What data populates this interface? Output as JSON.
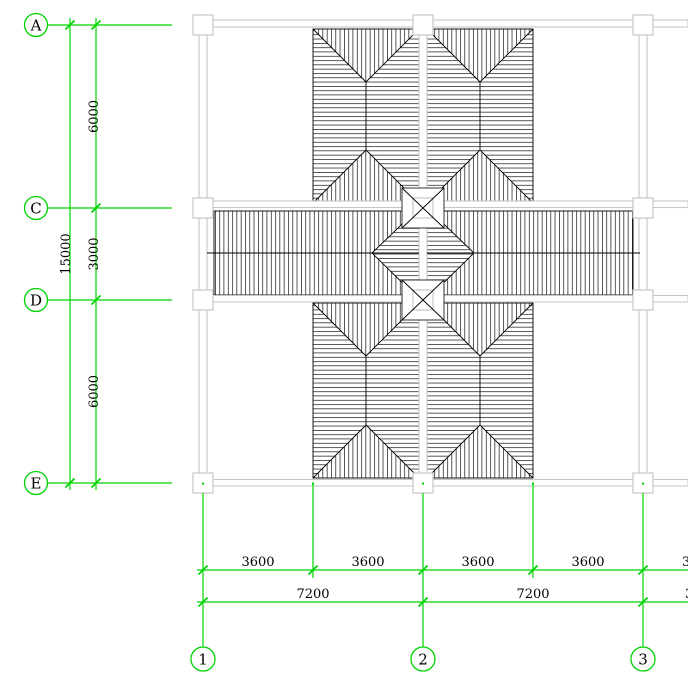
{
  "drawing_title": "roof-framing-plan",
  "canvas": {
    "w": 688,
    "h": 693,
    "bg": "#ffffff"
  },
  "colors": {
    "grid_green": "#00d400",
    "beam_gray": "#c6c6c6",
    "ink_black": "#000000"
  },
  "hatch": {
    "spacing": 4.3,
    "stroke_w": 0.7
  },
  "row_axes": [
    {
      "label": "A",
      "y": 25
    },
    {
      "label": "C",
      "y": 208
    },
    {
      "label": "D",
      "y": 300
    },
    {
      "label": "E",
      "y": 483
    }
  ],
  "col_axes": [
    {
      "label": "1",
      "x": 203
    },
    {
      "label": "2",
      "x": 423
    },
    {
      "label": "3",
      "x": 643
    }
  ],
  "axis_circles": {
    "left_cx": 36,
    "left_r": 11.5,
    "bottom_cy": 659,
    "bottom_r": 12,
    "row_line_x1": 47.5,
    "row_line_x2": 172
  },
  "left_dims": {
    "overall_line_x": 70,
    "overall_text": "15000",
    "overall_text_x": 70,
    "seg_line_x": 96,
    "seg_text_x": 98,
    "segs": [
      {
        "text": "6000",
        "y1": 25,
        "y2": 208
      },
      {
        "text": "3000",
        "y1": 208,
        "y2": 300
      },
      {
        "text": "6000",
        "y1": 300,
        "y2": 483
      }
    ],
    "line_top_y": 18,
    "line_bot_y": 490
  },
  "bottom_dims": {
    "row1": {
      "y": 570,
      "x1": 197,
      "x2": 688,
      "ticks": [
        203,
        313,
        423,
        533,
        643
      ],
      "labels": [
        {
          "text": "3600",
          "cx": 258
        },
        {
          "text": "3600",
          "cx": 368
        },
        {
          "text": "3600",
          "cx": 478
        },
        {
          "text": "3600",
          "cx": 588
        }
      ],
      "partial": {
        "text": "3600",
        "x": 682
      }
    },
    "row2": {
      "y": 602,
      "x1": 197,
      "x2": 688,
      "ticks": [
        203,
        423,
        643
      ],
      "labels": [
        {
          "text": "7200",
          "cx": 313
        },
        {
          "text": "7200",
          "cx": 533
        }
      ],
      "partial": {
        "text": "3600",
        "x": 685
      }
    },
    "ext_half_x": [
      313,
      533
    ],
    "ext_half_y1": 484,
    "ext_half_y2": 578,
    "ext_col_y1": 493,
    "ext_col_y2": 647,
    "dot_y": 483.5
  },
  "roof": {
    "panels": [
      {
        "x1": 313,
        "y1": 29,
        "x2": 419,
        "y2": 203
      },
      {
        "x1": 427,
        "y1": 29,
        "x2": 533,
        "y2": 203
      },
      {
        "x1": 313,
        "y1": 303,
        "x2": 419,
        "y2": 478
      },
      {
        "x1": 427,
        "y1": 303,
        "x2": 533,
        "y2": 478
      }
    ],
    "bars": [
      {
        "x1": 214,
        "y1": 211,
        "x2": 419,
        "y2": 295
      },
      {
        "x1": 427,
        "y1": 211,
        "x2": 633,
        "y2": 295
      }
    ],
    "ridge": {
      "y": 253,
      "segs": [
        [
          207,
          419
        ],
        [
          427,
          640
        ]
      ]
    },
    "diamond": {
      "left": [
        372,
        253
      ],
      "top": [
        423,
        204
      ],
      "right": [
        474,
        253
      ],
      "bottom": [
        423,
        303
      ]
    },
    "bowties": [
      {
        "x1": 402,
        "y1": 188,
        "x2": 444,
        "y2": 228
      },
      {
        "x1": 402,
        "y1": 280,
        "x2": 444,
        "y2": 320
      }
    ]
  },
  "structure": {
    "beams_h": [
      {
        "x1": 195,
        "x2": 688,
        "y1": 20,
        "y2": 27
      },
      {
        "x1": 195,
        "x2": 688,
        "y1": 201,
        "y2": 207.5
      },
      {
        "x1": 195,
        "x2": 688,
        "y1": 295.5,
        "y2": 302
      },
      {
        "x1": 195,
        "x2": 688,
        "y1": 479.5,
        "y2": 486
      }
    ],
    "beams_v": [
      {
        "y1": 25,
        "y2": 483,
        "x1": 199,
        "x2": 207
      },
      {
        "y1": 25,
        "y2": 483,
        "x1": 419,
        "x2": 427
      },
      {
        "y1": 25,
        "y2": 483,
        "x1": 639,
        "x2": 647
      }
    ],
    "column_size": 20,
    "columns": [
      [
        203,
        25
      ],
      [
        423,
        25
      ],
      [
        643,
        25
      ],
      [
        203,
        208
      ],
      [
        423,
        208
      ],
      [
        643,
        208
      ],
      [
        203,
        300
      ],
      [
        423,
        300
      ],
      [
        643,
        300
      ],
      [
        203,
        483
      ],
      [
        423,
        483
      ],
      [
        643,
        483
      ]
    ]
  }
}
